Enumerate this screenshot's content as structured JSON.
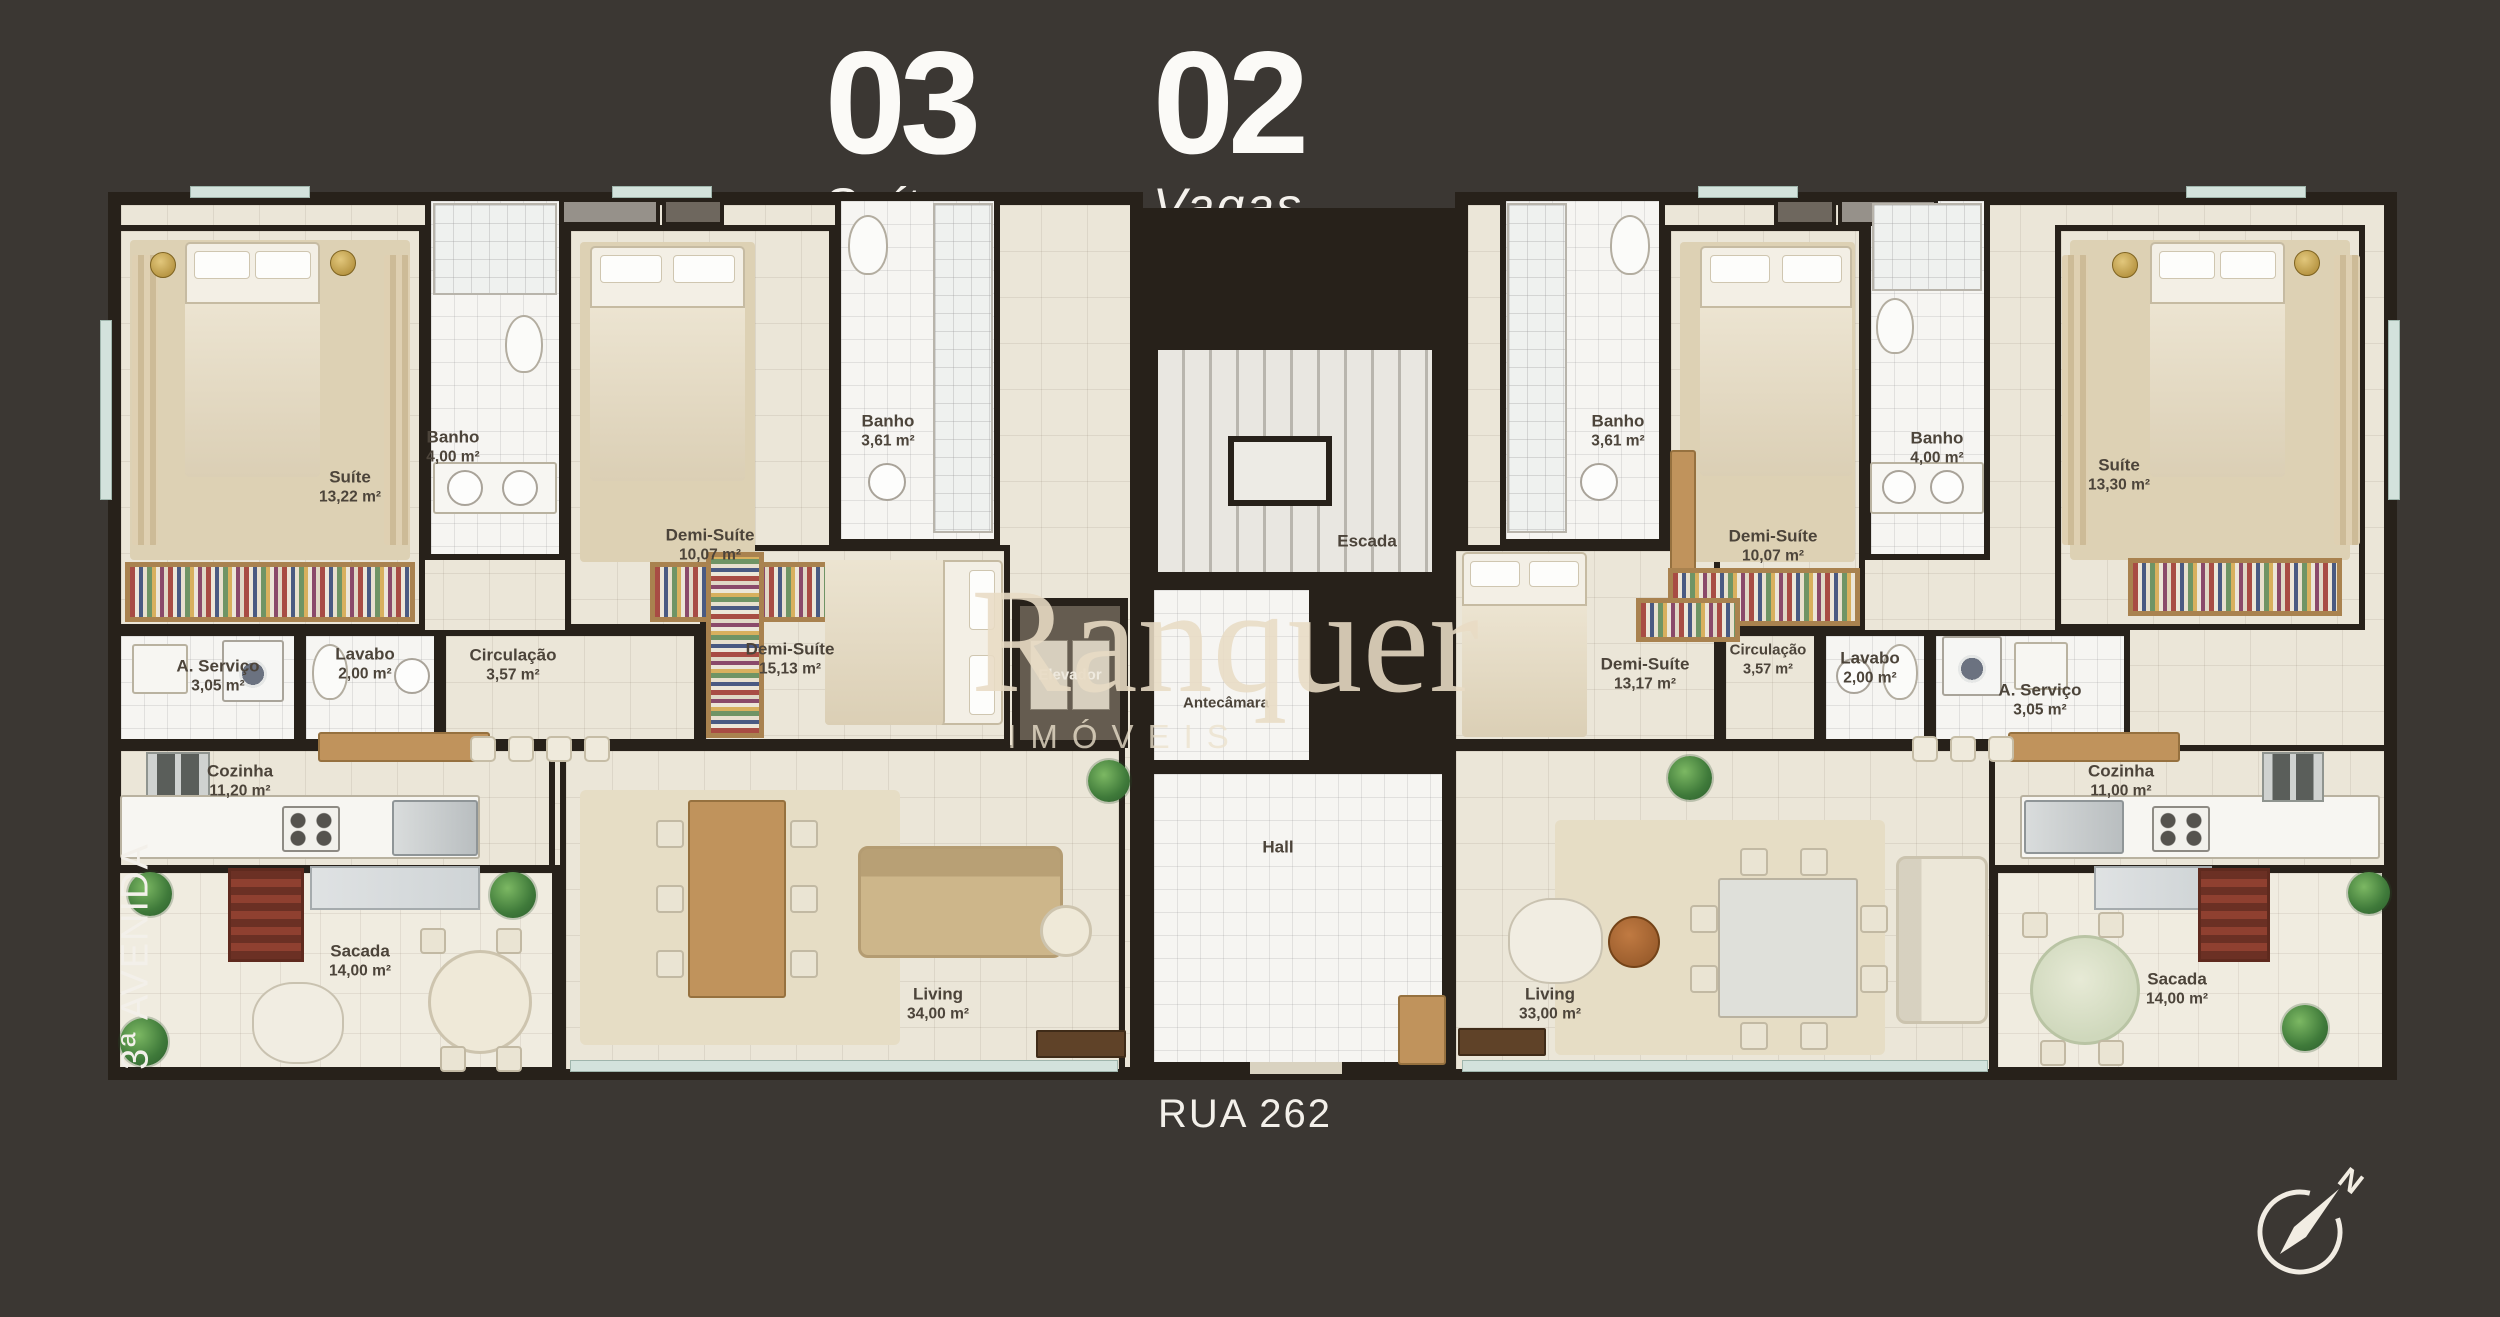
{
  "header": {
    "stats": [
      {
        "value": "03",
        "label": "Suítes"
      },
      {
        "value": "02",
        "label": "Vagas"
      }
    ]
  },
  "streets": {
    "bottom": "RUA 262",
    "left": "3ª AVENIDA"
  },
  "watermark": {
    "brand": "Ranquer",
    "subtitle": "IMÓVEIS"
  },
  "compass": {
    "north": "N"
  },
  "units": {
    "left": {
      "rooms": [
        {
          "name": "Suíte",
          "area": "13,22 m²"
        },
        {
          "name": "Banho",
          "area": "4,00 m²"
        },
        {
          "name": "Demi-Suíte",
          "area": "10,07 m²"
        },
        {
          "name": "Banho",
          "area": "3,61 m²"
        },
        {
          "name": "A. Serviço",
          "area": "3,05 m²"
        },
        {
          "name": "Lavabo",
          "area": "2,00 m²"
        },
        {
          "name": "Circulação",
          "area": "3,57 m²"
        },
        {
          "name": "Demi-Suíte",
          "area": "15,13 m²"
        },
        {
          "name": "Cozinha",
          "area": "11,20 m²"
        },
        {
          "name": "Sacada",
          "area": "14,00 m²"
        },
        {
          "name": "Living",
          "area": "34,00 m²"
        }
      ]
    },
    "core": {
      "rooms": [
        {
          "name": "Escada"
        },
        {
          "name": "Elevador"
        },
        {
          "name": "Antecâmara"
        },
        {
          "name": "Hall"
        }
      ]
    },
    "right": {
      "rooms": [
        {
          "name": "Banho",
          "area": "3,61 m²"
        },
        {
          "name": "Demi-Suíte",
          "area": "10,07 m²"
        },
        {
          "name": "Banho",
          "area": "4,00 m²"
        },
        {
          "name": "Suíte",
          "area": "13,30 m²"
        },
        {
          "name": "Demi-Suíte",
          "area": "13,17 m²"
        },
        {
          "name": "Circulação",
          "area": "3,57 m²"
        },
        {
          "name": "Lavabo",
          "area": "2,00 m²"
        },
        {
          "name": "A. Serviço",
          "area": "3,05 m²"
        },
        {
          "name": "Living",
          "area": "33,00 m²"
        },
        {
          "name": "Cozinha",
          "area": "11,00 m²"
        },
        {
          "name": "Sacada",
          "area": "14,00 m²"
        }
      ]
    }
  },
  "colors": {
    "background": "#3b3733",
    "walls": "#27211a",
    "floor": "#ebe6d8",
    "wood": "#c0935c"
  }
}
